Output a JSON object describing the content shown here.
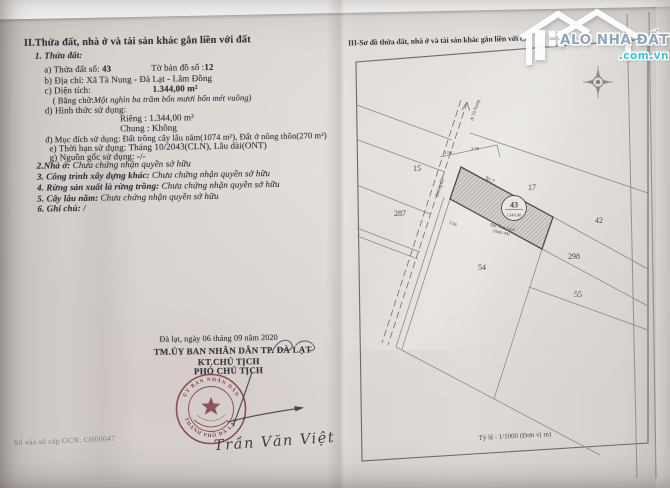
{
  "left_page": {
    "section_title": "II.Thửa đất, nhà ở và tài sản khác gắn liền với đất",
    "sub_title": "1. Thửa đất:",
    "fields": {
      "a_label": "a) Thửa đất số: ",
      "a_value": "43",
      "a2_label": "Tờ bản đồ số :",
      "a2_value": "12",
      "b_label": "b) Địa chỉ: ",
      "b_value": "Xã Tà Nung - Đà Lạt - Lâm Đồng",
      "c_label": "c) Diện tích:",
      "c_value": "1.344,00 m²",
      "c_words_label": "( Bằng chữ:",
      "c_words_value": "Một nghìn ba trăm bốn mươi bốn mét vuông)",
      "d_label": "d) Hình thức sử dụng:",
      "d_rieng": "Riêng : 1.344,00 m²",
      "d_chung": "Chung : Không",
      "dd_label": "đ) Mục đích sử dụng: ",
      "dd_value": "Đất trồng cây lâu năm(1074 m²), Đất ở nông thôn(270 m²)",
      "e_label": "e) Thời hạn sử dụng: ",
      "e_value": "Tháng 10/2043(CLN), Lâu dài(ONT)",
      "g_label": "g) Nguồn gốc sử dụng: ",
      "g_value": "-/-"
    },
    "sections": {
      "s2_label": "2.Nhà ở: ",
      "s2_value": "Chưa chứng nhận quyền sở hữu",
      "s3_label": "3. Công trình xây dựng khác: ",
      "s3_value": "Chưa chứng nhận quyền sở hữu",
      "s4_label": "4. Rừng sản xuất là rừng trồng: ",
      "s4_value": "Chưa chứng nhận quyền sở hữu",
      "s5_label": "5. Cây lâu năm: ",
      "s5_value": "Chưa chứng nhận quyền sở hữu",
      "s6_label": "6. Ghi chú: ",
      "s6_value": "/"
    },
    "signing": {
      "date_line": "Đà lạt, ngày 06 tháng 09 năm 2020",
      "committee": "TM.ỦY BAN NHÂN DÂN TP. ĐÀ LẠT",
      "kt_line": "KT.CHỦ TỊCH",
      "deputy_line": "PHÓ CHỦ TỊCH",
      "signer_name": "Trần Văn Việt",
      "stamp_text_top": "ỦY BAN NHÂN DÂN",
      "stamp_text_bottom": "THÀNH PHỐ ĐÀ LẠT",
      "stamp_color": "#8d4150",
      "book_no": "Số vào sổ cấp GCN: CH00047"
    }
  },
  "right_page": {
    "section_title": "III-Sơ đồ thửa đất, nhà ở và tài sản khác gắn liền với đất",
    "scale_note": "Tỷ lệ : 1/1000 (Đơn vị m)",
    "map": {
      "main_parcel": {
        "number": "43",
        "area": "1344,00",
        "note1": "Đất Ông Linh",
        "note2": "(thửa 44)"
      },
      "neighbors": {
        "n15": "15",
        "n287": "287",
        "n17": "17",
        "n42": "42",
        "n298": "298",
        "n54": "54",
        "n55": "55"
      },
      "dims": {
        "d1": "1.98",
        "d2": "3.98",
        "d3": "30.7",
        "d4": "5.96"
      },
      "roads": {
        "direction": "đi Tà Nung",
        "name": "đường đất"
      }
    }
  },
  "watermark": {
    "brand": "ALO NHÀ ĐẤT",
    "domain": ".com.vn",
    "brand_color": "#90a4ba",
    "domain_color": "#3cc4d9"
  }
}
